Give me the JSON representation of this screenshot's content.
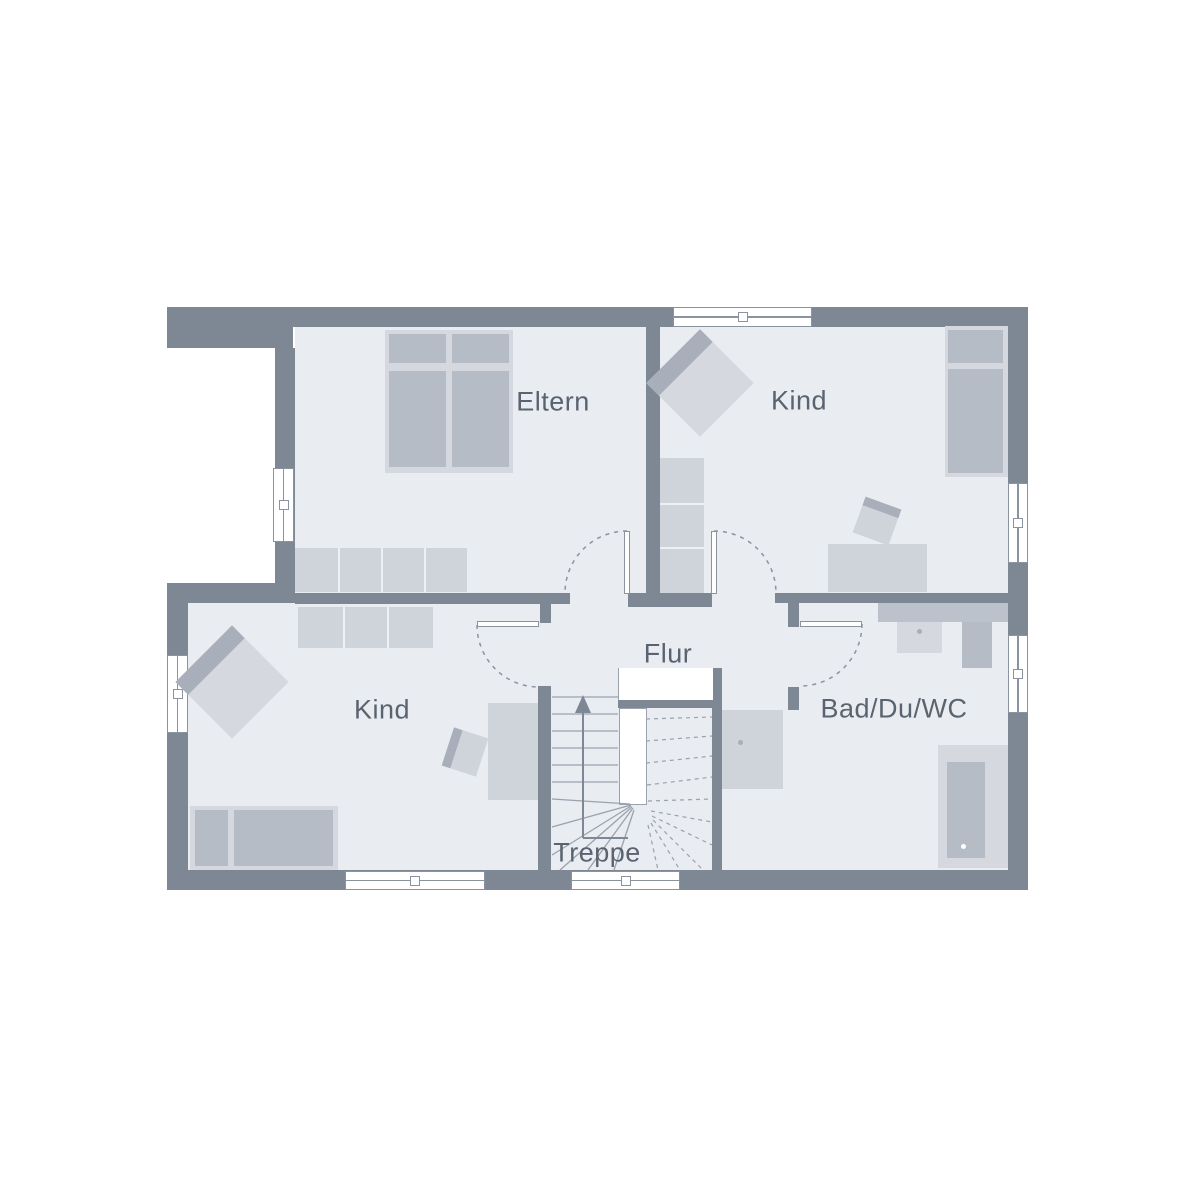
{
  "palette": {
    "paper": "#ffffff",
    "wall": "#7e8794",
    "floor": "#e9ecf0",
    "outline": "#8a93a0",
    "line": "#9aa2ae",
    "text": "#5a6370",
    "furnLight": "#d5d9df",
    "furnMid": "#cfd4db",
    "furnDark": "#b6bcc6",
    "accent": "#a8afbb",
    "counter": "#bcc2cb"
  },
  "rooms": [
    {
      "id": "eltern",
      "label": "Eltern"
    },
    {
      "id": "kind-upper",
      "label": "Kind"
    },
    {
      "id": "kind-lower",
      "label": "Kind"
    },
    {
      "id": "flur",
      "label": "Flur"
    },
    {
      "id": "bad",
      "label": "Bad/Du/WC"
    },
    {
      "id": "treppe",
      "label": "Treppe"
    }
  ],
  "furniture": {
    "eltern": [
      "double-bed",
      "wardrobe"
    ],
    "kind_upper": [
      "armchair",
      "wardrobe",
      "single-bed",
      "desk",
      "chair"
    ],
    "kind_lower": [
      "armchair",
      "wardrobe",
      "single-bed",
      "desk",
      "chair"
    ],
    "bad": [
      "counter",
      "washbasin",
      "wc",
      "shower",
      "bathtub"
    ],
    "treppe": [
      "winder-staircase",
      "direction-arrow"
    ]
  }
}
